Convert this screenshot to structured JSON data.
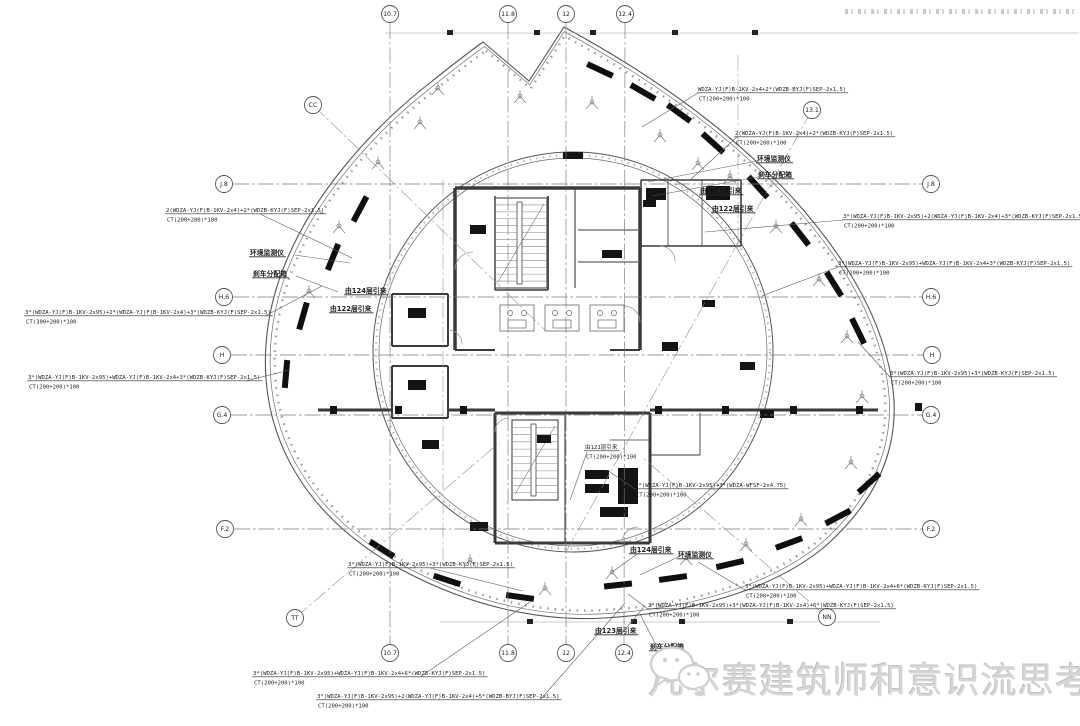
{
  "watermark": {
    "text": "凡尔赛建筑师和意识流思考者",
    "icon": "wechat-icon",
    "color": "#d6d6d6"
  },
  "grid": {
    "left": [
      {
        "label": "J.8",
        "x": 224,
        "y": 184
      },
      {
        "label": "H.6",
        "x": 224,
        "y": 297
      },
      {
        "label": "H",
        "x": 222,
        "y": 355
      },
      {
        "label": "G.4",
        "x": 222,
        "y": 415
      },
      {
        "label": "F.2",
        "x": 225,
        "y": 529
      }
    ],
    "right": [
      {
        "label": "J.8",
        "x": 931,
        "y": 184
      },
      {
        "label": "H.6",
        "x": 931,
        "y": 297
      },
      {
        "label": "H",
        "x": 932,
        "y": 355
      },
      {
        "label": "G.4",
        "x": 931,
        "y": 415
      },
      {
        "label": "F.2",
        "x": 931,
        "y": 529
      }
    ],
    "top": [
      {
        "label": "10.7",
        "x": 390,
        "y": 14
      },
      {
        "label": "11.8",
        "x": 508,
        "y": 14
      },
      {
        "label": "12",
        "x": 566,
        "y": 14
      },
      {
        "label": "12.4",
        "x": 625,
        "y": 14
      }
    ],
    "bottom": [
      {
        "label": "10.7",
        "x": 390,
        "y": 653
      },
      {
        "label": "11.8",
        "x": 508,
        "y": 653
      },
      {
        "label": "12",
        "x": 566,
        "y": 653
      },
      {
        "label": "12.4",
        "x": 624,
        "y": 653
      }
    ],
    "diagonal": [
      {
        "label": "CC",
        "x": 313,
        "y": 105,
        "leader": [
          545,
          330
        ]
      },
      {
        "label": "13.1",
        "x": 812,
        "y": 110,
        "leader": [
          566,
          552
        ]
      },
      {
        "label": "TT",
        "x": 295,
        "y": 618,
        "leader": [
          500,
          442
        ]
      },
      {
        "label": "NN",
        "x": 827,
        "y": 617,
        "leader": [
          642,
          457
        ]
      }
    ]
  },
  "cable_annotations": [
    {
      "spec": "2(WDZA-YJ(F)B-1KV-2x4)+2*(WDZB-KYJ(F)SEP-2x1.5)",
      "ct": "CT(200+200)*100",
      "x": 166,
      "y": 207,
      "leader": [
        [
          260,
          214
        ],
        [
          352,
          258
        ]
      ]
    },
    {
      "spec": "3*(WDZA-YJ(F)B-1KV-2x95)+2*(WDZA-YJ(F)B-1KV-2x4)+3*(WDZB-KYJ(F)SEP-2x1.5)",
      "ct": "CT(300+200)*100",
      "x": 25,
      "y": 309,
      "leader": [
        [
          265,
          316
        ],
        [
          322,
          286
        ]
      ]
    },
    {
      "spec": "3*(WDZA-YJ(F)B-1KV-2x95)+WDZA-YJ(F)B-1KV-2x4+3*(WDZB-KYJ(F)SEP-2x1.5)",
      "ct": "CT(200+200)*100",
      "x": 28,
      "y": 374,
      "leader": [
        [
          245,
          381
        ],
        [
          290,
          370
        ]
      ]
    },
    {
      "spec": "3*(WDZA-YJ(F)B-1KV-2x95)+3*(WDZB-KYJ(F)SEP-2x1.5)",
      "ct": "CT(200+200)*100",
      "x": 348,
      "y": 561,
      "leader": [
        [
          430,
          568
        ],
        [
          523,
          591
        ]
      ]
    },
    {
      "spec": "3*(WDZA-YJ(F)B-1KV-2x95)+WDZA-YJ(F)B-1KV-2x4+6*(WDZB-KYJ(F)SEP-2x1.5)",
      "ct": "CT(200+200)*100",
      "x": 253,
      "y": 670,
      "leader": [
        [
          420,
          677
        ],
        [
          530,
          602
        ]
      ]
    },
    {
      "spec": "3*(WDZA-YJ(F)B-1KV-2x95)+2(WDZA-YJ(F)B-1KV-2x4)+5*(WDZB-BYJ(F)SEP-2x1.5)",
      "ct": "CT(200+200)*100",
      "x": 317,
      "y": 693,
      "leader": [
        [
          540,
          700
        ],
        [
          625,
          603
        ]
      ]
    },
    {
      "spec": "WDZA-YJ(F)B-1KV-2x4+2*(WDZB-BYJ(F)SEP-2x1.5)",
      "ct": "CT(200+200)*100",
      "x": 698,
      "y": 86,
      "leader": [
        [
          698,
          93
        ],
        [
          642,
          127
        ]
      ]
    },
    {
      "spec": "2(WDZA-YJ(F)B-1KV-2x4)+2*(WDZB-KYJ(F)SEP-2x1.5)",
      "ct": "CT(200+200)*100",
      "x": 735,
      "y": 130,
      "leader": [
        [
          737,
          137
        ],
        [
          690,
          180
        ]
      ]
    },
    {
      "spec": "3*(WDZA-YJ(F)B-1KV-2x95)+2(WDZA-YJ(F)B-1KV-2x4)+3*(WDZB-KYJ(F)SEP-2x1.5)",
      "ct": "CT(200+200)*100",
      "x": 843,
      "y": 213,
      "leader": [
        [
          843,
          220
        ],
        [
          705,
          232
        ]
      ]
    },
    {
      "spec": "3*(WDZA-YJ(F)B-1KV-2x95)+WDZA-YJ(F)B-1KV-2x4+3*(WDZB-KYJ(F)SEP-2x1.5)",
      "ct": "CT(200+200)*100",
      "x": 838,
      "y": 260,
      "leader": [
        [
          838,
          267
        ],
        [
          762,
          296
        ]
      ]
    },
    {
      "spec": "3*(WDZA-YJ(F)B-1KV-2x95)+3*(WDZB-KYJ(F)SEP-2x1.5)",
      "ct": "CT(200+200)*100",
      "x": 890,
      "y": 370,
      "leader": [
        [
          890,
          377
        ],
        [
          858,
          342
        ]
      ]
    },
    {
      "spec": "3*(WDZA-YJ(F)B-1KV-2x95)+3*(WDZA-WFSF-2x4.75)",
      "ct": "CT(200+200)*100",
      "x": 635,
      "y": 482,
      "leader": [
        [
          635,
          489
        ],
        [
          607,
          470
        ]
      ]
    },
    {
      "spec": "3*(WDZA-YJ(F)B-1KV-2x95)+WDZA-YJ(F)B-1KV-2x4+6*(WDZB-KYJ(F)SEP-2x1.5)",
      "ct": "CT(200+200)*100",
      "x": 745,
      "y": 583,
      "leader": [
        [
          745,
          590
        ],
        [
          698,
          562
        ]
      ]
    },
    {
      "spec": "3*(WDZA-YJ(F)B-1KV-2x95)+3*(WDZA-YJ(F)B-1KV-2x4)+6*(WDZB-KYJ(F)SEP-2x1.5)",
      "ct": "CT(200+200)*100",
      "x": 648,
      "y": 602,
      "leader": [
        [
          648,
          609
        ],
        [
          628,
          594
        ]
      ]
    },
    {
      "spec": "由121层引来",
      "ct": "CT(200+200)*100",
      "x": 585,
      "y": 444,
      "leader": [
        [
          587,
          452
        ],
        [
          570,
          500
        ]
      ]
    }
  ],
  "callout_labels": [
    {
      "text": "环境监测仪",
      "x": 250,
      "y": 249,
      "leader": [
        [
          295,
          255
        ],
        [
          350,
          263
        ]
      ]
    },
    {
      "text": "刹车分配箱",
      "x": 253,
      "y": 270,
      "leader": [
        [
          296,
          276
        ],
        [
          338,
          292
        ]
      ]
    },
    {
      "text": "由124层引来",
      "x": 345,
      "y": 287,
      "leader": null
    },
    {
      "text": "由122层引来",
      "x": 330,
      "y": 305,
      "leader": null
    },
    {
      "text": "环境监测仪",
      "x": 757,
      "y": 155,
      "leader": [
        [
          757,
          161
        ],
        [
          648,
          182
        ]
      ]
    },
    {
      "text": "刹车分配箱",
      "x": 758,
      "y": 171,
      "leader": [
        [
          758,
          177
        ],
        [
          652,
          196
        ]
      ]
    },
    {
      "text": "由124层引来",
      "x": 700,
      "y": 187,
      "leader": null
    },
    {
      "text": "由122层引来",
      "x": 712,
      "y": 205,
      "leader": null
    },
    {
      "text": "由124层引来",
      "x": 630,
      "y": 546,
      "leader": [
        [
          640,
          552
        ],
        [
          612,
          572
        ]
      ]
    },
    {
      "text": "环境监测仪",
      "x": 678,
      "y": 551,
      "leader": [
        [
          678,
          557
        ],
        [
          640,
          575
        ]
      ]
    },
    {
      "text": "由123层引来",
      "x": 595,
      "y": 627,
      "leader": [
        [
          622,
          633
        ],
        [
          643,
          608
        ]
      ]
    },
    {
      "text": "刹车分配箱",
      "x": 650,
      "y": 643,
      "leader": [
        [
          658,
          649
        ],
        [
          640,
          614
        ]
      ]
    }
  ],
  "colors": {
    "line": "#4a4a4a",
    "wall": "#3a3a3a",
    "light": "#999999",
    "grid": "#777777",
    "watermark": "#d6d6d6"
  }
}
